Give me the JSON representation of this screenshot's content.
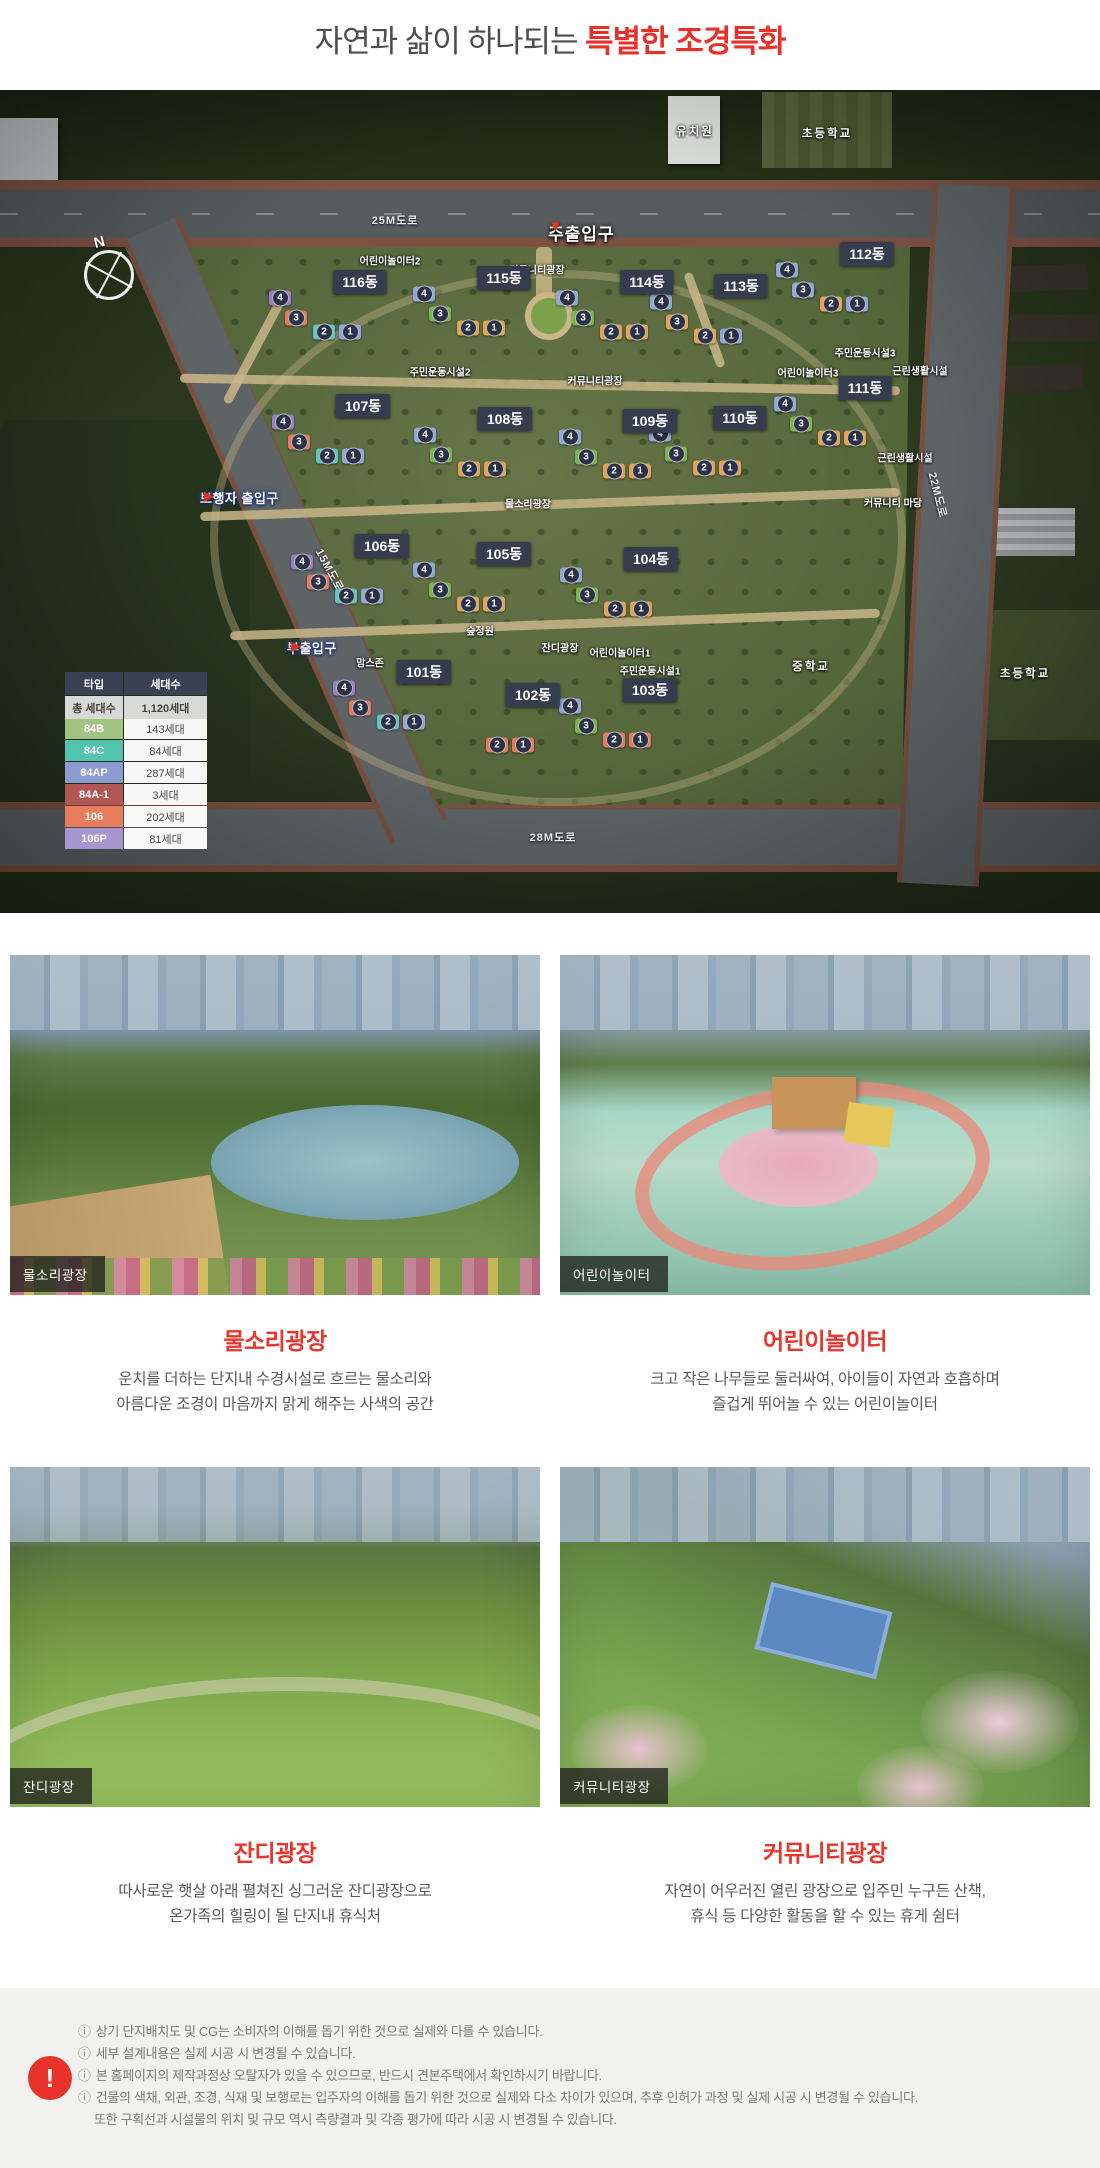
{
  "header": {
    "title_normal": "자연과 삶이 하나되는 ",
    "title_accent": "특별한 조경특화",
    "accent_color": "#e8302a"
  },
  "map": {
    "north_label": "N",
    "road_labels": [
      {
        "label": "25M도로",
        "x": 395,
        "y": 130,
        "rot": 0
      },
      {
        "label": "28M도로",
        "x": 553,
        "y": 747,
        "rot": 0
      },
      {
        "label": "15M도로",
        "x": 330,
        "y": 480,
        "rot": 62
      },
      {
        "label": "22M도로",
        "x": 938,
        "y": 405,
        "rot": 76
      }
    ],
    "entrances": [
      {
        "label": "주출입구",
        "x": 548,
        "y": 130,
        "arrow": "▼",
        "type": "main"
      },
      {
        "label": "보행자 출입구",
        "x": 200,
        "y": 398,
        "arrow": "▶",
        "type": "sub"
      },
      {
        "label": "부출입구",
        "x": 287,
        "y": 548,
        "arrow": "▶",
        "type": "sub"
      }
    ],
    "buildings": [
      {
        "label": "116동",
        "x": 360,
        "y": 192,
        "units": [
          {
            "n": "4",
            "c": "#9b7fc4"
          },
          {
            "n": "3",
            "c": "#e87a5a"
          },
          {
            "n": "2",
            "c": "#5bc8c0"
          },
          {
            "n": "1",
            "c": "#8fa8d8"
          }
        ]
      },
      {
        "label": "115동",
        "x": 504,
        "y": 188,
        "units": [
          {
            "n": "4",
            "c": "#8fa8d8"
          },
          {
            "n": "3",
            "c": "#7ab648"
          },
          {
            "n": "2",
            "c": "#e8a14f"
          },
          {
            "n": "1",
            "c": "#e8a14f"
          }
        ]
      },
      {
        "label": "114동",
        "x": 647,
        "y": 192,
        "units": [
          {
            "n": "4",
            "c": "#8fa8d8"
          },
          {
            "n": "3",
            "c": "#7ab648"
          },
          {
            "n": "2",
            "c": "#e8a14f"
          },
          {
            "n": "1",
            "c": "#e8a14f"
          }
        ]
      },
      {
        "label": "113동",
        "x": 741,
        "y": 196,
        "units": [
          {
            "n": "4",
            "c": "#8fa8d8"
          },
          {
            "n": "3",
            "c": "#e8a14f"
          },
          {
            "n": "2",
            "c": "#e8a14f"
          },
          {
            "n": "1",
            "c": "#8fa8d8"
          }
        ]
      },
      {
        "label": "112동",
        "x": 867,
        "y": 164,
        "units": [
          {
            "n": "4",
            "c": "#8fa8d8"
          },
          {
            "n": "3",
            "c": "#8fa8d8"
          },
          {
            "n": "2",
            "c": "#e8a14f"
          },
          {
            "n": "1",
            "c": "#8fa8d8"
          }
        ]
      },
      {
        "label": "107동",
        "x": 363,
        "y": 316,
        "units": [
          {
            "n": "4",
            "c": "#9b7fc4"
          },
          {
            "n": "3",
            "c": "#e87a5a"
          },
          {
            "n": "2",
            "c": "#5bc8c0"
          },
          {
            "n": "1",
            "c": "#8fa8d8"
          }
        ]
      },
      {
        "label": "108동",
        "x": 505,
        "y": 329,
        "units": [
          {
            "n": "4",
            "c": "#8fa8d8"
          },
          {
            "n": "3",
            "c": "#7ab648"
          },
          {
            "n": "2",
            "c": "#e8a14f"
          },
          {
            "n": "1",
            "c": "#e8a14f"
          }
        ]
      },
      {
        "label": "109동",
        "x": 650,
        "y": 331,
        "units": [
          {
            "n": "4",
            "c": "#8fa8d8"
          },
          {
            "n": "3",
            "c": "#7ab648"
          },
          {
            "n": "2",
            "c": "#e8a14f"
          },
          {
            "n": "1",
            "c": "#e8a14f"
          }
        ]
      },
      {
        "label": "110동",
        "x": 740,
        "y": 328,
        "units": [
          {
            "n": "4",
            "c": "#8fa8d8"
          },
          {
            "n": "3",
            "c": "#7ab648"
          },
          {
            "n": "2",
            "c": "#e8a14f"
          },
          {
            "n": "1",
            "c": "#e8a14f"
          }
        ]
      },
      {
        "label": "111동",
        "x": 865,
        "y": 298,
        "units": [
          {
            "n": "4",
            "c": "#8fa8d8"
          },
          {
            "n": "3",
            "c": "#7ab648"
          },
          {
            "n": "2",
            "c": "#e8a14f"
          },
          {
            "n": "1",
            "c": "#e8a14f"
          }
        ]
      },
      {
        "label": "106동",
        "x": 382,
        "y": 456,
        "units": [
          {
            "n": "4",
            "c": "#9b7fc4"
          },
          {
            "n": "3",
            "c": "#e87a5a"
          },
          {
            "n": "2",
            "c": "#5bc8c0"
          },
          {
            "n": "1",
            "c": "#8fa8d8"
          }
        ]
      },
      {
        "label": "105동",
        "x": 504,
        "y": 464,
        "units": [
          {
            "n": "4",
            "c": "#8fa8d8"
          },
          {
            "n": "3",
            "c": "#7ab648"
          },
          {
            "n": "2",
            "c": "#e8a14f"
          },
          {
            "n": "1",
            "c": "#e8a14f"
          }
        ]
      },
      {
        "label": "104동",
        "x": 651,
        "y": 469,
        "units": [
          {
            "n": "4",
            "c": "#8fa8d8"
          },
          {
            "n": "3",
            "c": "#7ab648"
          },
          {
            "n": "2",
            "c": "#e8a14f"
          },
          {
            "n": "1",
            "c": "#e8a14f"
          }
        ]
      },
      {
        "label": "101동",
        "x": 424,
        "y": 582,
        "units": [
          {
            "n": "4",
            "c": "#9b7fc4"
          },
          {
            "n": "3",
            "c": "#e87a5a"
          },
          {
            "n": "2",
            "c": "#5bc8c0"
          },
          {
            "n": "1",
            "c": "#8fa8d8"
          }
        ]
      },
      {
        "label": "102동",
        "x": 533,
        "y": 605,
        "units": [
          {
            "n": "2",
            "c": "#e87a5a"
          },
          {
            "n": "1",
            "c": "#e87a5a"
          }
        ]
      },
      {
        "label": "103동",
        "x": 650,
        "y": 600,
        "units": [
          {
            "n": "4",
            "c": "#8fa8d8"
          },
          {
            "n": "3",
            "c": "#7ab648"
          },
          {
            "n": "2",
            "c": "#e87a5a"
          },
          {
            "n": "1",
            "c": "#e87a5a"
          }
        ]
      }
    ],
    "facilities": [
      {
        "label": "어린이놀이터2",
        "x": 390,
        "y": 170
      },
      {
        "label": "커뮤니티광장",
        "x": 537,
        "y": 179
      },
      {
        "label": "주민운동시설2",
        "x": 440,
        "y": 281
      },
      {
        "label": "커뮤니티광장",
        "x": 595,
        "y": 290
      },
      {
        "label": "주민운동시설3",
        "x": 865,
        "y": 262
      },
      {
        "label": "어린이놀이터3",
        "x": 808,
        "y": 282
      },
      {
        "label": "근린생활시설",
        "x": 920,
        "y": 280
      },
      {
        "label": "근린생활시설",
        "x": 905,
        "y": 367
      },
      {
        "label": "커뮤니티 마당",
        "x": 893,
        "y": 412
      },
      {
        "label": "물소리광장",
        "x": 528,
        "y": 413
      },
      {
        "label": "숲정원",
        "x": 480,
        "y": 540
      },
      {
        "label": "맘스존",
        "x": 370,
        "y": 572
      },
      {
        "label": "잔디광장",
        "x": 560,
        "y": 557
      },
      {
        "label": "어린이놀이터1",
        "x": 620,
        "y": 562
      },
      {
        "label": "주민운동시설1",
        "x": 650,
        "y": 580
      },
      {
        "label": "유치원",
        "x": 695,
        "y": 41,
        "big": true
      },
      {
        "label": "초등학교",
        "x": 827,
        "y": 43,
        "big": true
      },
      {
        "label": "중학교",
        "x": 811,
        "y": 576,
        "big": true
      },
      {
        "label": "초등학교",
        "x": 1025,
        "y": 583,
        "big": true
      }
    ],
    "legend": {
      "headers": [
        "타입",
        "세대수"
      ],
      "rows": [
        {
          "type": "84A",
          "color": "#e8a455",
          "count": "320세대"
        },
        {
          "type": "84B",
          "color": "#a3c383",
          "count": "143세대"
        },
        {
          "type": "84C",
          "color": "#52c3ac",
          "count": "84세대"
        },
        {
          "type": "84AP",
          "color": "#8b9bd1",
          "count": "287세대"
        },
        {
          "type": "84A-1",
          "color": "#b25654",
          "count": "3세대"
        },
        {
          "type": "106",
          "color": "#e97c5b",
          "count": "202세대"
        },
        {
          "type": "106P",
          "color": "#a795cd",
          "count": "81세대"
        }
      ],
      "total": {
        "label": "총 세대수",
        "count": "1,120세대"
      }
    }
  },
  "sections": [
    {
      "badge": "물소리광장",
      "title": "물소리광장",
      "desc1": "운치를 더하는 단지내 수경시설로 흐르는 물소리와",
      "desc2": "아름다운 조경이 마음까지 맑게 해주는 사색의 공간"
    },
    {
      "badge": "어린이놀이터",
      "title": "어린이놀이터",
      "desc1": "크고 작은 나무들로 둘러싸여, 아이들이 자연과 호흡하며",
      "desc2": "즐겁게 뛰어놀 수 있는 어린이놀이터"
    },
    {
      "badge": "잔디광장",
      "title": "잔디광장",
      "desc1": "따사로운 햇살 아래 펼쳐진 싱그러운 잔디광장으로",
      "desc2": "온가족의 힐링이 될 단지내 휴식처"
    },
    {
      "badge": "커뮤니티광장",
      "title": "커뮤니티광장",
      "desc1": "자연이 어우러진 열린 광장으로 입주민 누구든 산책,",
      "desc2": "휴식 등 다양한 활동을 할 수 있는 휴게 쉼터"
    }
  ],
  "footer": {
    "icon": "!",
    "notes": [
      {
        "bullet": "ⓘ",
        "text": "상기 단지배치도 및 CG는 소비자의 이해를 돕기 위한 것으로 실제와 다를 수 있습니다."
      },
      {
        "bullet": "ⓘ",
        "text": "세부 설계내용은 실제 시공 시 변경될 수 있습니다."
      },
      {
        "bullet": "ⓘ",
        "text": "본 홈페이지의 제작과정상 오탈자가 있을 수 있으므로, 반드시 견본주택에서 확인하시기 바랍니다."
      },
      {
        "bullet": "ⓘ",
        "text": "건물의 색채, 외관, 조경, 식재 및 보행로는 입주자의 이해를 돕기 위한 것으로 실제와 다소 차이가 있으며, 추후 인허가 과정 및 실제 시공 시 변경될 수 있습니다."
      },
      {
        "bullet": "",
        "text": "또한 구획선과 시설물의 위치 및 규모 역시 측량결과 및 각종 평가에 따라 시공 시 변경될 수 있습니다."
      }
    ]
  }
}
